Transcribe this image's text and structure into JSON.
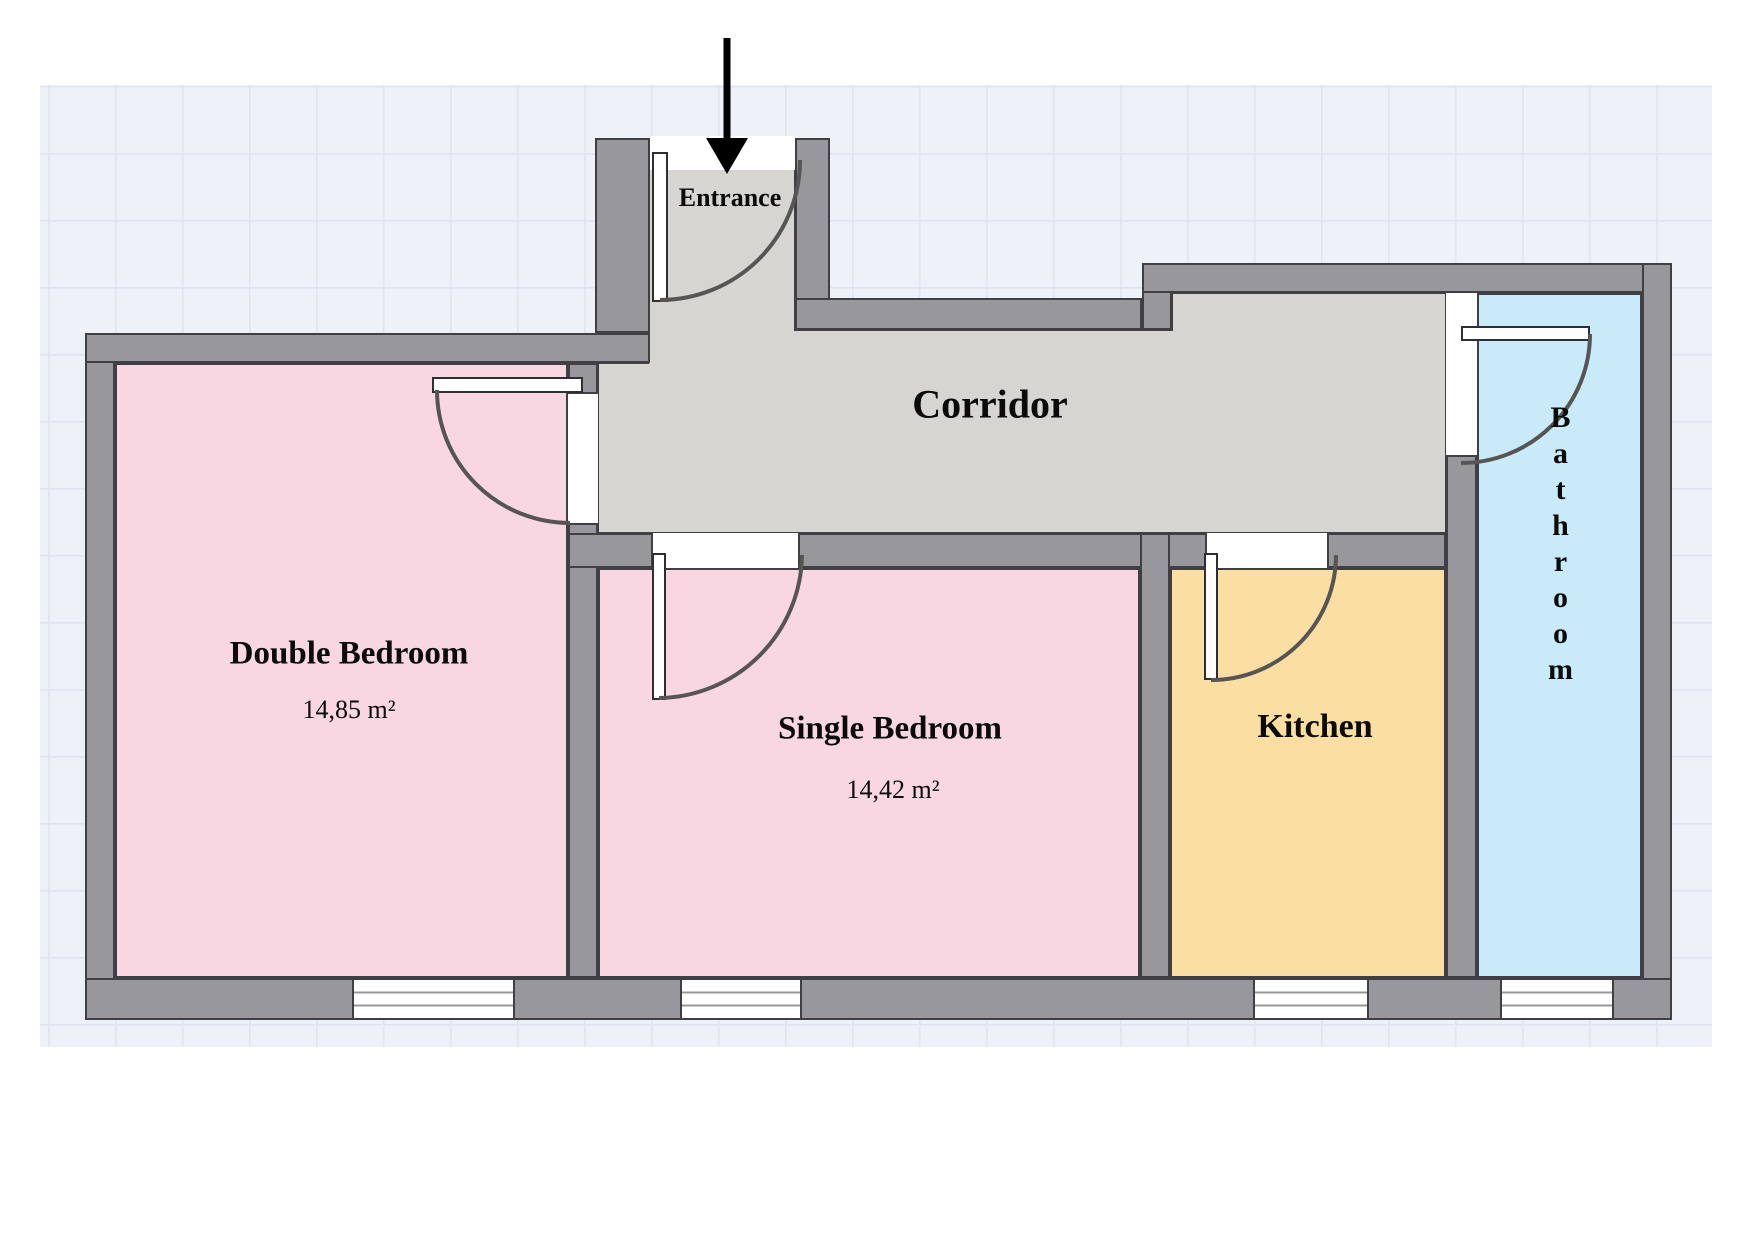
{
  "plan": {
    "entrance": {
      "label": "Entrance"
    },
    "corridor": {
      "label": "Corridor"
    },
    "rooms": {
      "double_bedroom": {
        "label": "Double Bedroom",
        "area": "14,85 m²"
      },
      "single_bedroom": {
        "label": "Single Bedroom",
        "area": "14,42 m²"
      },
      "kitchen": {
        "label": "Kitchen"
      },
      "bathroom": {
        "label": "Bathroom"
      }
    },
    "colors": {
      "wall_fill": "#98979B",
      "wall_outline": "#3F3F44",
      "corridor_floor": "#D6D5D2",
      "bedroom_floor": "#F8D7E2",
      "kitchen_floor": "#FBDFA2",
      "bathroom_floor": "#C9EBF9",
      "grid_background": "#EEF1F8",
      "door_arc": "#565553",
      "arrow": "#000000"
    }
  }
}
